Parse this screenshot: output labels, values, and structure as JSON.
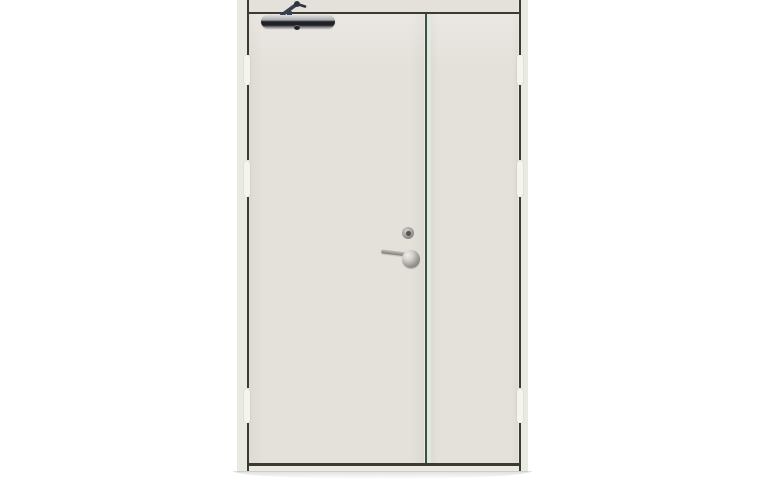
{
  "scene": {
    "subject": "Beige double-leaf steel door with overhead door closer, product photo on plain white background",
    "parts": {
      "frame": "Door frame",
      "transom": "Frame head above leaves",
      "leaf_active": "Active door leaf (wide, left)",
      "leaf_inactive": "Inactive door leaf (narrow, right)",
      "meeting_stile": "Meeting gap between the two leaves",
      "closer_body": "Overhead door closer body",
      "closer_arm": "Door closer arm",
      "cylinder": "Lock cylinder",
      "handle_rose": "Lever handle rose",
      "handle_lever": "Lever handle",
      "hinge": "Hinge gap on leaf edge",
      "floor_shadow": "Soft shadow under the door"
    }
  },
  "colors": {
    "bg": "#ffffff",
    "frame": "#ebe9e1",
    "frame-tint": "#e8ebe1",
    "leaf": "#e4e0da",
    "line-dark": "#3c3b33",
    "meeting-dark": "#3f4f44",
    "meeting-light": "#dfe9dd",
    "hinge": "#f5f4ef",
    "closer-hi": "#dcdee0",
    "closer-silver": "#aaacaf",
    "closer-band": "#1f2127",
    "arm": "#38404f",
    "hardware-light": "#d2d0cb",
    "hardware-dark": "#6e6c68",
    "cyl-mid": "#9b9893",
    "cyl-core": "#55534f",
    "lever": "#9b9893"
  }
}
